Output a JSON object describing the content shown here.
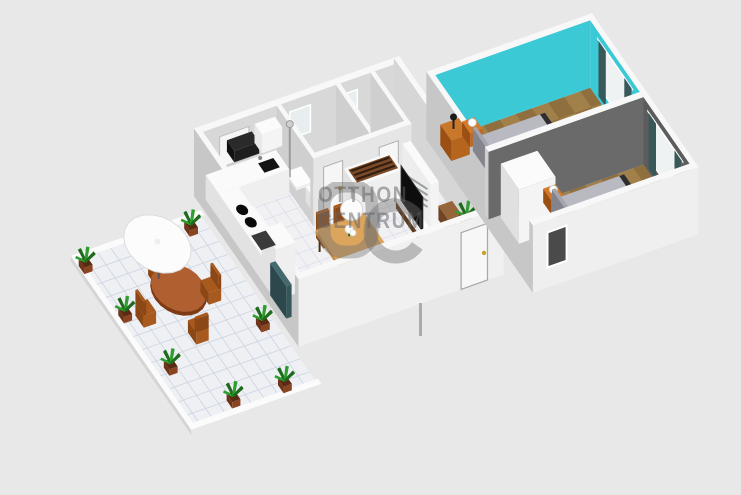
{
  "watermark": {
    "monogram": "OC",
    "line1": "OTTHON",
    "line2": "CENTRUM"
  },
  "palette": {
    "background": "#e8e8e8",
    "wall_front": "#f0f0f0",
    "wall_side": "#c7c7c7",
    "wall_top": "#f8f8f8",
    "wall_inner": "#d8d8d8",
    "teal_wall": "#3bc9d6",
    "dark_wall": "#5c5c5c",
    "divider_wall": "#6a6a6a",
    "wood_floor": "#a28049",
    "wood_floor_dark": "#8f6f3e",
    "tile_floor": "#f1f1f4",
    "tile_grid": "#dcdfe9",
    "patio_floor": "#eef0f3",
    "patio_grid": "#ccd4e2",
    "bath_floor": "#4e4e4e",
    "bath_grid": "#434343",
    "counter_white": "#fafafa",
    "counter_front": "#efefef",
    "counter_side": "#e2e2e2",
    "appliance_black": "#141414",
    "island_top": "#7a4a28",
    "island_stripe": "#2f1d10",
    "dining_table": "#dca55e",
    "dining_table_side": "#c28b43",
    "chair_wood": "#a8591d",
    "chair_dark": "#8c4716",
    "patio_table": "#b06030",
    "patio_table_dark": "#7d3a14",
    "sofa_blue": "#1c1c8e",
    "sofa_blue_dark": "#15157a",
    "rug_gray": "#5e5e5e",
    "bed_top": "#b9b9c1",
    "bed_side": "#a3a3ab",
    "bed_head": "#97979f",
    "bed_frame_dark": "#2e2e2e",
    "nightstand_orange": "#c2661a",
    "nightstand_dark": "#9c4f12",
    "wardrobe_white": "#f4f4f4",
    "wardrobe_side": "#e0e0e0",
    "curtain": "#39585a",
    "window_white": "#eef2f2",
    "window_dark": "#4a4a4a",
    "plant_green": "#2f9e2f",
    "plant_green_dark": "#1e6b1e",
    "pot_brown": "#8a4520",
    "umbrella_white": "#fcfcfc",
    "radiator_teal": "#37565a",
    "gold": "#c9a227",
    "watermark_gray": "rgba(105,105,105,0.48)"
  },
  "scene": {
    "description": "3D dollhouse floor plan render of an apartment with terrace",
    "rooms": [
      {
        "name": "patio-terrace"
      },
      {
        "name": "kitchen"
      },
      {
        "name": "dining-area"
      },
      {
        "name": "living-room"
      },
      {
        "name": "bathroom"
      },
      {
        "name": "toilet"
      },
      {
        "name": "bedroom-1-teal"
      },
      {
        "name": "bedroom-2-gray"
      }
    ],
    "furniture": [
      "round-patio-table",
      "patio-chairs",
      "patio-umbrella",
      "potted-plants",
      "kitchen-counters",
      "range-hood",
      "cooktop",
      "sink",
      "kitchen-island",
      "dining-table",
      "dining-chairs",
      "pendant-lamp",
      "tv",
      "tv-cabinet",
      "blue-armchair",
      "area-rug",
      "side-table",
      "bathtub-counter",
      "shower",
      "toilet-seat",
      "double-beds",
      "nightstands",
      "wardrobe",
      "desk",
      "curtains"
    ]
  }
}
